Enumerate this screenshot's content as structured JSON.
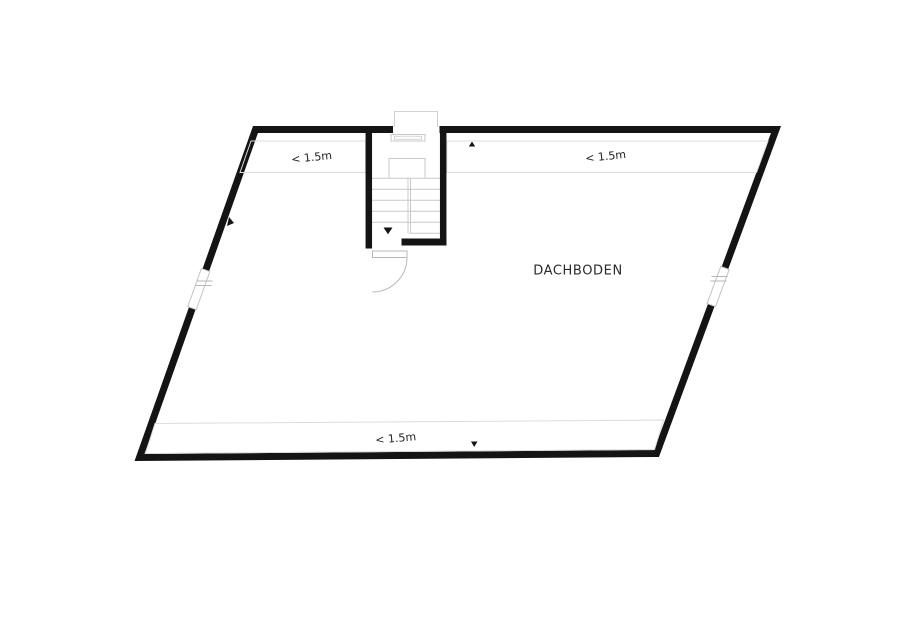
{
  "floorplan": {
    "room": {
      "label": "DACHBODEN"
    },
    "zones": [
      {
        "id": "top-left-low-ceiling",
        "label": "< 1.5m"
      },
      {
        "id": "top-right-low-ceiling",
        "label": "< 1.5m"
      },
      {
        "id": "bottom-low-ceiling",
        "label": "< 1.5m"
      }
    ],
    "features": {
      "stair": "staircase",
      "door": "door-with-swing-arc",
      "windows": [
        "left-wall-window",
        "right-wall-window"
      ]
    },
    "colors": {
      "wall": "#141414",
      "stair_line": "#c9c9c9",
      "zone_outline": "#dcdcdc",
      "door_line": "#b8b8b8",
      "text": "#222222",
      "background": "#ffffff"
    }
  }
}
